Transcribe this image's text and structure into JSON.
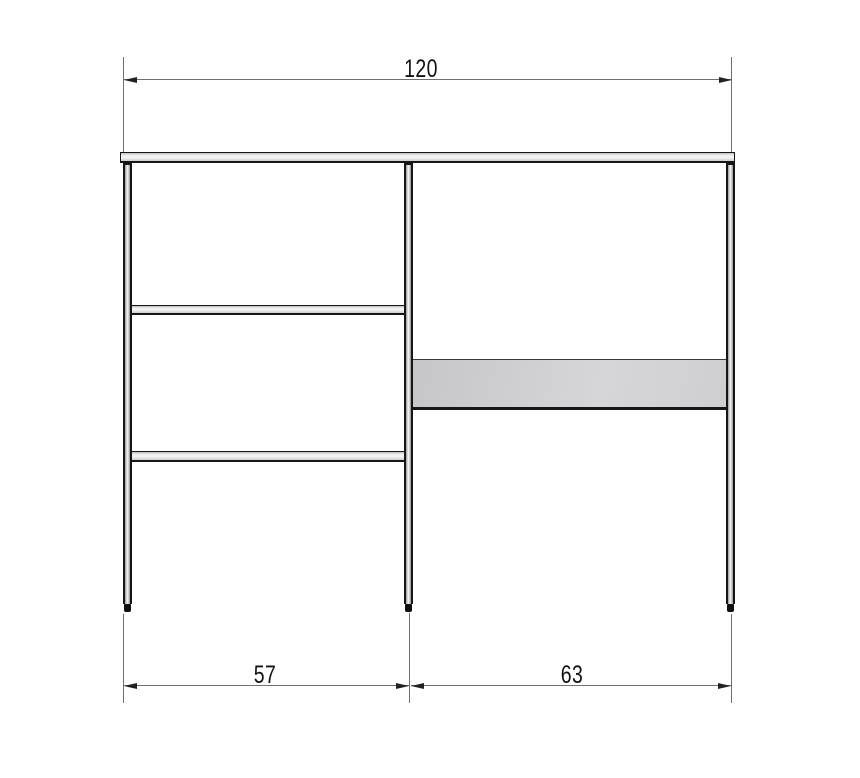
{
  "diagram": {
    "kind": "furniture-front-view-dimension-drawing",
    "background": "#ffffff"
  },
  "dimensions": {
    "top": {
      "label": "120"
    },
    "bottom_left": {
      "label": "57"
    },
    "bottom_right": {
      "label": "63"
    }
  },
  "parts": {
    "tabletop": "top slab spanning full width",
    "posts": [
      "left post",
      "middle post",
      "right post"
    ],
    "left_bay_crossbars": [
      "upper crossbar",
      "lower crossbar"
    ],
    "right_bay_panel": "gray back panel",
    "feet": 3
  },
  "colors": {
    "outline": "#161616",
    "dimension_line": "#707070",
    "arrow": "#222222",
    "text": "#111111",
    "frame_fill_light": "#f2f2f2",
    "frame_fill_shade": "#8f8f8f",
    "panel_fill": "#d2d2d4"
  }
}
